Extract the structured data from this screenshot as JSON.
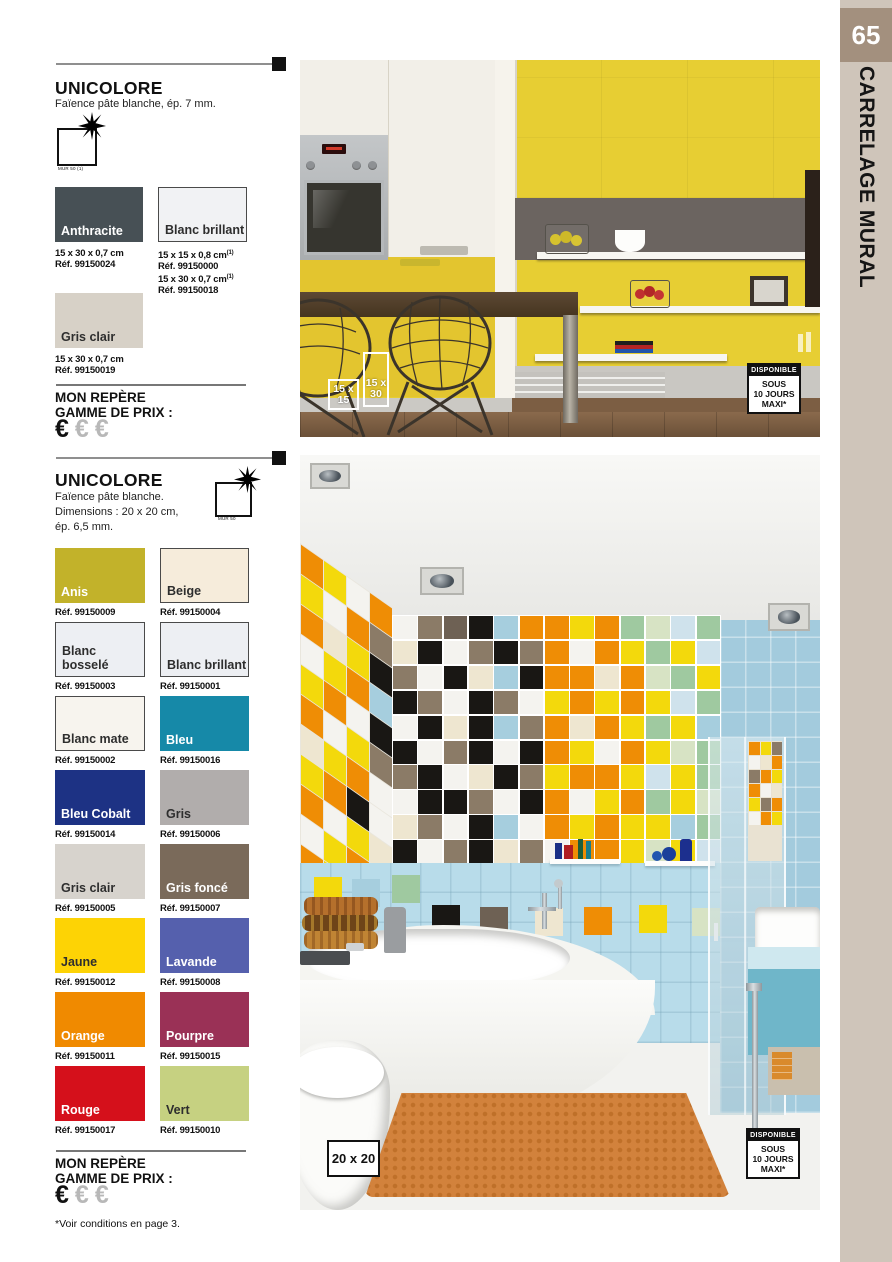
{
  "page": {
    "number": "65",
    "edge_label": "CARRELAGE MURAL",
    "footnote": "*Voir conditions en page 3."
  },
  "price_block": {
    "line1": "MON REPÈRE",
    "line2": "GAMME DE PRIX :",
    "euro": "€"
  },
  "products": [
    {
      "title": "UNICOLORE",
      "description": "Faïence pâte blanche, ép. 7 mm.",
      "icon_caption": "MUR 50 (1)",
      "swatches": [
        {
          "name": "Anthracite",
          "color": "#475055",
          "text": "light",
          "lines": [
            "15 x 30 x 0,7 cm",
            "Réf. 99150024"
          ]
        },
        {
          "name": "Blanc brillant",
          "color": "#f1f2f4",
          "text": "dark",
          "bordered": true,
          "sup": "(1)",
          "lines": [
            "15 x 15 x 0,8 cm",
            "Réf. 99150000",
            "15 x 30 x 0,7 cm",
            "Réf. 99150018"
          ]
        },
        {
          "name": "Gris clair",
          "color": "#d7d1c7",
          "text": "dark",
          "lines": [
            "15 x 30 x 0,7 cm",
            "Réf. 99150019"
          ]
        }
      ]
    },
    {
      "title": "UNICOLORE",
      "description_lines": [
        "Faïence pâte blanche.",
        "Dimensions : 20 x 20 cm,",
        "ép. 6,5 mm."
      ],
      "icon_caption": "MUR 50",
      "swatches": [
        {
          "name": "Anis",
          "color": "#c2b22a",
          "text": "light",
          "ref": "Réf. 99150009"
        },
        {
          "name": "Beige",
          "color": "#f6ecdb",
          "text": "dark",
          "bordered": true,
          "ref": "Réf. 99150004"
        },
        {
          "name": "Blanc bosselé",
          "color": "#edeff3",
          "text": "dark",
          "bordered": true,
          "ref": "Réf. 99150003"
        },
        {
          "name": "Blanc brillant",
          "color": "#edeff3",
          "text": "dark",
          "bordered": true,
          "ref": "Réf. 99150001"
        },
        {
          "name": "Blanc mate",
          "color": "#f7f4ee",
          "text": "dark",
          "bordered": true,
          "ref": "Réf. 99150002"
        },
        {
          "name": "Bleu",
          "color": "#1689a8",
          "text": "light",
          "ref": "Réf. 99150016"
        },
        {
          "name": "Bleu Cobalt",
          "color": "#1d3284",
          "text": "light",
          "ref": "Réf. 99150014"
        },
        {
          "name": "Gris",
          "color": "#b1adac",
          "text": "dark",
          "ref": "Réf. 99150006"
        },
        {
          "name": "Gris clair",
          "color": "#d7d3cd",
          "text": "dark",
          "ref": "Réf. 99150005"
        },
        {
          "name": "Gris foncé",
          "color": "#7a6a5a",
          "text": "light",
          "ref": "Réf. 99150007"
        },
        {
          "name": "Jaune",
          "color": "#fdd305",
          "text": "dark",
          "ref": "Réf. 99150012"
        },
        {
          "name": "Lavande",
          "color": "#5560ad",
          "text": "light",
          "ref": "Réf. 99150008"
        },
        {
          "name": "Orange",
          "color": "#f08a00",
          "text": "light",
          "ref": "Réf. 99150011"
        },
        {
          "name": "Pourpre",
          "color": "#9a3156",
          "text": "light",
          "ref": "Réf. 99150015"
        },
        {
          "name": "Rouge",
          "color": "#d5101b",
          "text": "light",
          "ref": "Réf. 99150017"
        },
        {
          "name": "Vert",
          "color": "#c6d181",
          "text": "dark",
          "ref": "Réf. 99150010"
        }
      ]
    }
  ],
  "photos": {
    "availability": {
      "header": "DISPONIBLE",
      "lines": [
        "SOUS",
        "10 JOURS",
        "MAXI*"
      ]
    },
    "kitchen": {
      "size_badges": [
        {
          "l1": "15 x",
          "l2": "15"
        },
        {
          "l1": "15 x",
          "l2": "30"
        }
      ]
    },
    "bathroom": {
      "size_badge": "20 x 20",
      "palette": {
        "O": "#ef8d05",
        "Y": "#f3d90c",
        "W": "#f4f3ef",
        "K": "#191714",
        "T": "#8b7b67",
        "D": "#6e6154",
        "C": "#eee6d0",
        "B": "#a6cede",
        "L": "#cfe2ec",
        "G": "#9fc9a0",
        "E": "#d7e3c4"
      },
      "front_rows": [
        "WTDKBOOYOGELG",
        "CKWTKTOWOYGYL",
        "TWKCBKOOCOEGY",
        "KTWKTWYOYOYLG",
        "WKCKBTOCOYGYB",
        "KWTKWKOYWOYEG",
        "TKWCKTYOOYLYG",
        "WKKTWKOWYOGYE",
        "CTWKBWOYOYYBG",
        "KWTKCTWOOYEYL"
      ],
      "left_rows": [
        "OYWO",
        "YWOT",
        "OCYK",
        "WYOB",
        "YOWK",
        "OWYT",
        "CYOW",
        "YOKW",
        "OWYC",
        "WYOT",
        "OYWK",
        "YWCO",
        "OTYW",
        "WOKY"
      ],
      "niche_rows": [
        "OYT",
        "WCO",
        "TOY",
        "OWC",
        "YTO",
        "WOY"
      ],
      "band_accents": [
        {
          "x": 14,
          "y": -8,
          "c": "Y"
        },
        {
          "x": 52,
          "y": -6,
          "c": "B"
        },
        {
          "x": 92,
          "y": -10,
          "c": "G"
        },
        {
          "x": 132,
          "y": 20,
          "c": "K"
        },
        {
          "x": 180,
          "y": 22,
          "c": "D"
        },
        {
          "x": 235,
          "y": 23,
          "c": "C"
        },
        {
          "x": 284,
          "y": 22,
          "c": "O"
        },
        {
          "x": 339,
          "y": 20,
          "c": "Y"
        },
        {
          "x": 392,
          "y": 23,
          "c": "E"
        }
      ]
    }
  }
}
